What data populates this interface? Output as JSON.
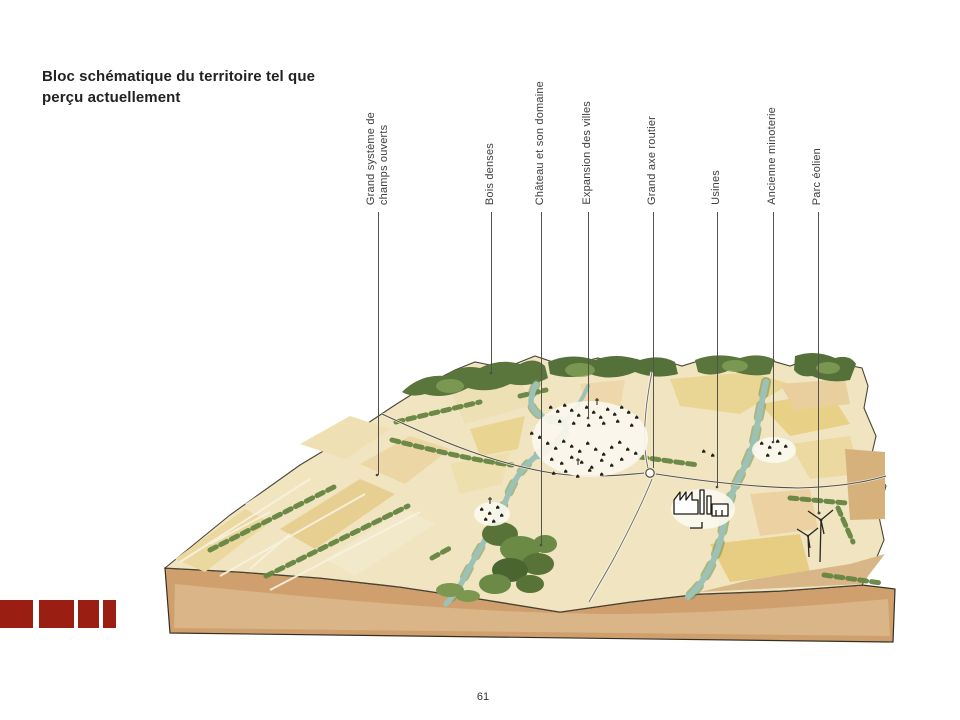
{
  "page": {
    "title_line1": "Bloc schématique du territoire tel que",
    "title_line2": "perçu actuellement",
    "number": "61"
  },
  "annotations": [
    {
      "text": "Grand système de\nchamps ouverts"
    },
    {
      "text": "Bois denses"
    },
    {
      "text": "Château et son domaine"
    },
    {
      "text": "Expansion des villes"
    },
    {
      "text": "Grand axe routier"
    },
    {
      "text": "Usines"
    },
    {
      "text": "Ancienne minoterie"
    },
    {
      "text": "Parc éolien"
    }
  ],
  "colors": {
    "accent_red": "#9a1e11",
    "title_ink": "#222220",
    "label_ink": "#3d3d3d",
    "leader_line": "#55524a",
    "field_base": "#f0e5c0",
    "field_yellow": "#e8d086",
    "field_peach": "#ecd2a2",
    "woods_green": "#5a763c",
    "river_teal": "#9cc2b8",
    "soil_brown": "#cfa06d",
    "outline": "#4a4538"
  }
}
